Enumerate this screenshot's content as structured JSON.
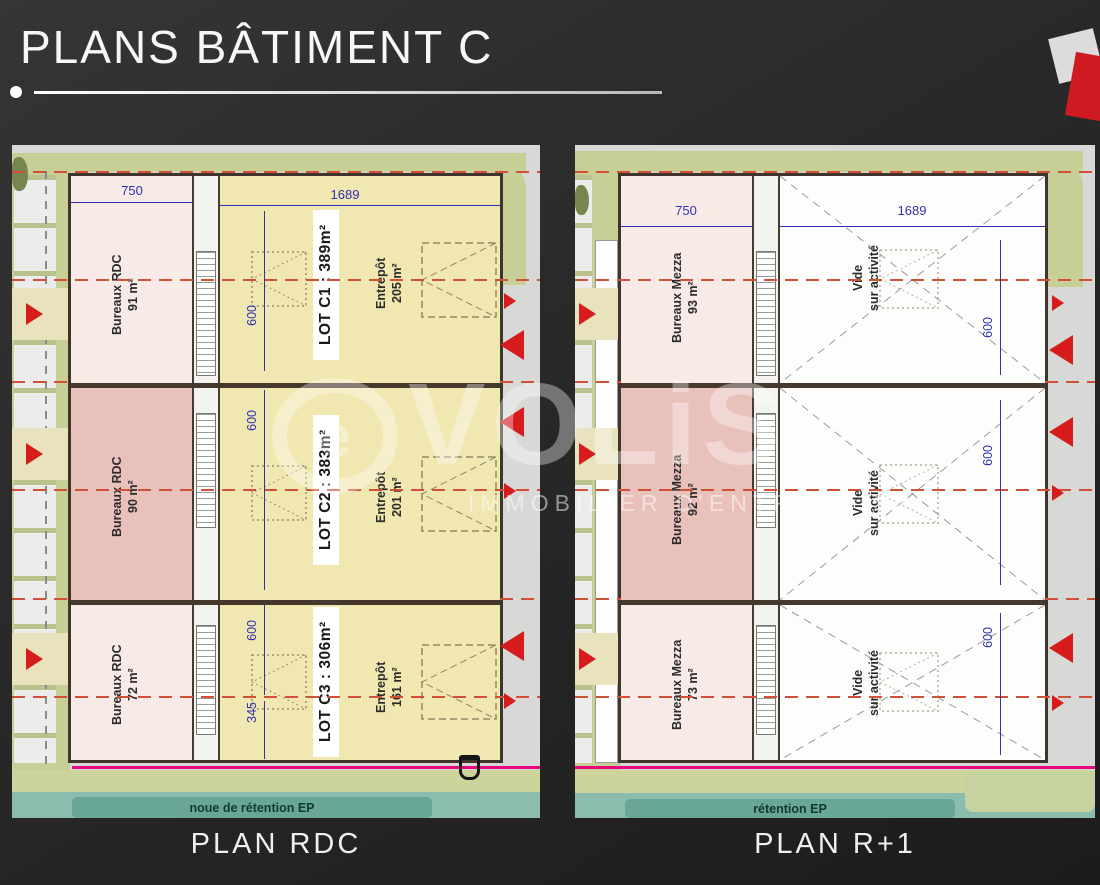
{
  "header": {
    "title": "PLANS BÂTIMENT C"
  },
  "watermark": {
    "logo_letter": "e",
    "letters": "VOLiS",
    "subtitle": "IMMOBILIER D'ENTREPRISE"
  },
  "footer": {
    "rdc_label": "PLAN RDC",
    "r1_label": "PLAN R+1"
  },
  "rdc": {
    "dim_bureaux_width": "750",
    "dim_zone_width": "1689",
    "retention": "noue de rétention EP",
    "lots": [
      {
        "lot": "LOT C1 : 389m²",
        "bureau": "Bureaux RDC",
        "bureau_area": "91 m²",
        "zone": "Entrepôt",
        "zone_area": "205 m²",
        "dim": "600"
      },
      {
        "lot": "LOT C2 : 383m²",
        "bureau": "Bureaux RDC",
        "bureau_area": "90 m²",
        "zone": "Entrepôt",
        "zone_area": "201 m²",
        "dim": "600"
      },
      {
        "lot": "LOT C3 : 306m²",
        "bureau": "Bureaux RDC",
        "bureau_area": "72 m²",
        "zone": "Entrepôt",
        "zone_area": "161 m²",
        "dim": "600",
        "dim2": "345"
      }
    ]
  },
  "r1": {
    "dim_bureaux_width": "750",
    "dim_zone_width": "1689",
    "retention": "rétention EP",
    "lots": [
      {
        "bureau": "Bureaux Mezza",
        "bureau_area": "93 m²",
        "vide1": "Vide",
        "vide2": "sur activité",
        "dim": "600"
      },
      {
        "bureau": "Bureaux Mezza",
        "bureau_area": "92 m²",
        "vide1": "Vide",
        "vide2": "sur activité",
        "dim": "600"
      },
      {
        "bureau": "Bureaux Mezza",
        "bureau_area": "73 m²",
        "vide1": "Vide",
        "vide2": "sur activité",
        "dim": "600"
      }
    ]
  },
  "colors": {
    "accent_red": "#d61c1c",
    "dim_blue": "#3030b5",
    "magenta": "#e8057f",
    "bureau_light": "#f8eae7",
    "bureau_dark": "#e8c1bb",
    "entrepot_yellow": "#f0e7b1",
    "landscape_green": "#c7cf97",
    "retention_teal": "#8cbcae"
  }
}
